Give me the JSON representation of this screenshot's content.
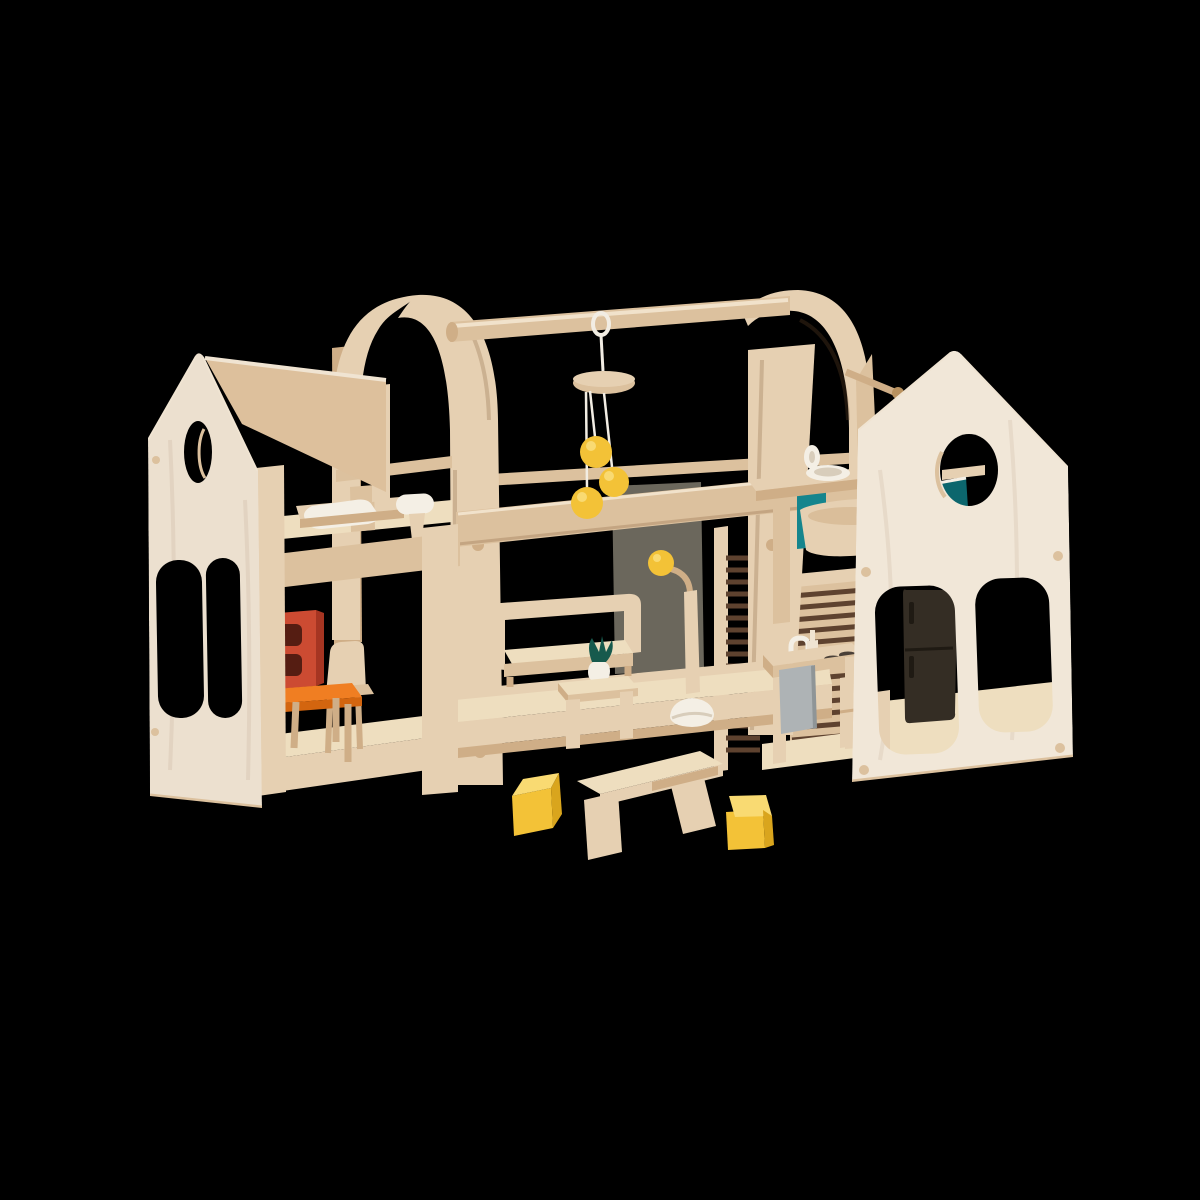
{
  "scene": {
    "description": "Wooden slide-and-go toy dollhouse play set with furniture, photographed on a black background",
    "left_house": "left gabled house module with circle cutout, bedroom upstairs and dining room downstairs",
    "carry_frame": "center bentwood arch carry frame with hanging pole",
    "mobile": "hanging mobile with wooden disc and three yellow balls",
    "living_room": "center living room with sofa, coffee table, plant and floor lamp",
    "bathroom": "upper right bathroom with washstand and tub",
    "kitchen": "lower right kitchen with counter, faucet, stove and fridge",
    "right_house": "right gabled house module with circle cutout and two rounded windows",
    "foreground": "wooden bench with two yellow cube stools"
  },
  "colors": {
    "bg": "#000000",
    "panel": "#ece0cf",
    "panel_right": "#f1e7d8",
    "wood_pale": "#f0e4d2",
    "floor_light": "#eedebf",
    "wood_light": "#e6d0b2",
    "wood": "#dcc19e",
    "wood_mid": "#cfae87",
    "wood_edge": "#b8915f",
    "roof_under": "#ddc09c",
    "white": "#f4efe5",
    "white_shade": "#d8cdbb",
    "string": "#f2ede3",
    "yellow": "#f3c237",
    "yellow_hi": "#f9da72",
    "yellow_dk": "#d9a51d",
    "orange": "#f07e22",
    "orange_dk": "#d3650f",
    "red": "#cc4b32",
    "red_dk": "#a63522",
    "red_hole": "#551d12",
    "teal": "#15858d",
    "teal_dk": "#0c666d",
    "leaf": "#175a4d",
    "slate": "#6b675c",
    "slat": "#5e422f",
    "stove": "#4a4038",
    "fridge": "#342d24",
    "fridge_dk": "#1f1a13",
    "gray": "#aeb3b5",
    "gray_dk": "#8f9597",
    "shade": "rgba(122,84,48,0.25)",
    "hilite": "rgba(255,248,234,0.6)"
  }
}
